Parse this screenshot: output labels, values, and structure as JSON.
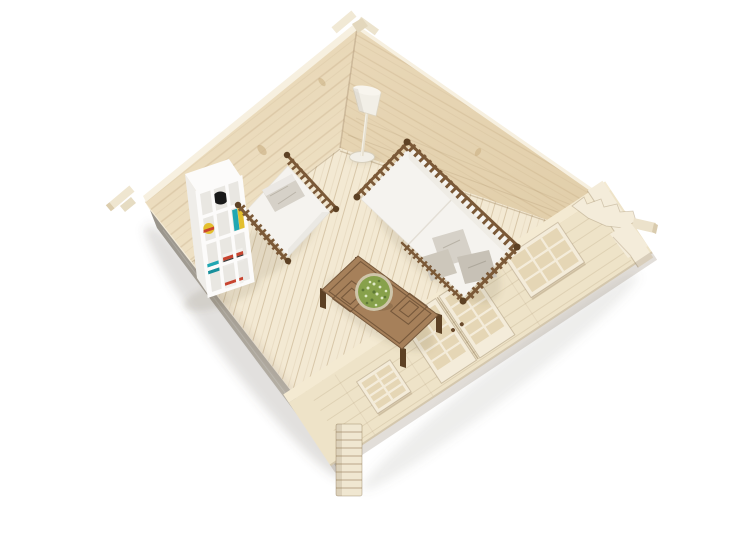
{
  "image": {
    "type": "product-photo",
    "description": "Aerial three-quarter view of an unpainted wooden log cabin model with the roof removed, revealing a furnished miniature interior on a white background.",
    "background": "#ffffff"
  },
  "scene": {
    "objects": [
      {
        "name": "log-cabin",
        "label": "Wooden log cabin shell, roofless aerial view"
      },
      {
        "name": "ground-shadow",
        "label": "Soft ground shadow under the cabin"
      },
      {
        "name": "left-wall-exterior",
        "label": "Shadowed exterior of front-left wall"
      },
      {
        "name": "floor",
        "label": "Light wooden plank floor"
      },
      {
        "name": "interior-walls",
        "label": "Interior faces of rear log walls"
      },
      {
        "name": "facade",
        "label": "Front facade with glazed door and lattice windows"
      },
      {
        "name": "glazed-door",
        "label": "Double glazed door with lattice panes and handles"
      },
      {
        "name": "small-window",
        "label": "Small lattice window near front corner"
      },
      {
        "name": "large-window",
        "label": "Large lattice window right of the door"
      },
      {
        "name": "corner-post",
        "label": "Notched log corner joint at front corner"
      },
      {
        "name": "right-corner-gable",
        "label": "Stepped gable end and purlin beam at right corner"
      },
      {
        "name": "gable-apex",
        "label": "Ridge beam stubs at rear gable apex"
      },
      {
        "name": "left-purlin-beam",
        "label": "Purlin beam stub at left corner"
      },
      {
        "name": "bookshelf",
        "label": "White cube bookshelf with books, bowl and ball"
      },
      {
        "name": "armchair-bed",
        "label": "Spindle-sided armchair bed with white mattress and grey pillow"
      },
      {
        "name": "daybed-sofa",
        "label": "Spindle-sided daybed sofa with white mattress and grey cushions"
      },
      {
        "name": "coffee-table",
        "label": "Carved dark wooden coffee table"
      },
      {
        "name": "potted-plant",
        "label": "Round potted succulent plant on the table"
      },
      {
        "name": "floor-lamp",
        "label": "White floor lamp with conical shade"
      }
    ]
  },
  "palette": {
    "bg": "#ffffff",
    "wood-wall": "#ebdabb",
    "wood-wall2": "#e6d4b2",
    "wood-edge": "#f7f0e0",
    "wood-floor": "#f3e9d3",
    "wood-facade": "#eee3c8",
    "facade-top": "#f4ead2",
    "trim": "#f4ecda",
    "pane": "#e5d6b5",
    "gray-dark": "#9d988e",
    "gray-light": "#c9c4ba",
    "furn-brown": "#7b5937",
    "furn-brown-dark": "#5d4124",
    "table-wood": "#a6805a",
    "table-line": "#77593c",
    "mattress": "#f5f3ef",
    "bolster": "#efece5",
    "pillow": "#d6d1c8",
    "pillow2": "#c7c1b6",
    "shelf-white": "#fcfbfa",
    "shelf-int": "#e9e7e2",
    "book-teal": "#20a7b2",
    "book-teal2": "#188f9b",
    "book-red": "#c8442f",
    "book-yellow": "#e3bf2e",
    "book-dark": "#3a3a3a",
    "plant-green": "#87a14b",
    "plant-dot-light": "#dde8c4",
    "plant-dot-dark": "#5d7836",
    "pot": "#cfc5aa",
    "lamp": "#f2efe7",
    "bowl-black": "#191919"
  }
}
